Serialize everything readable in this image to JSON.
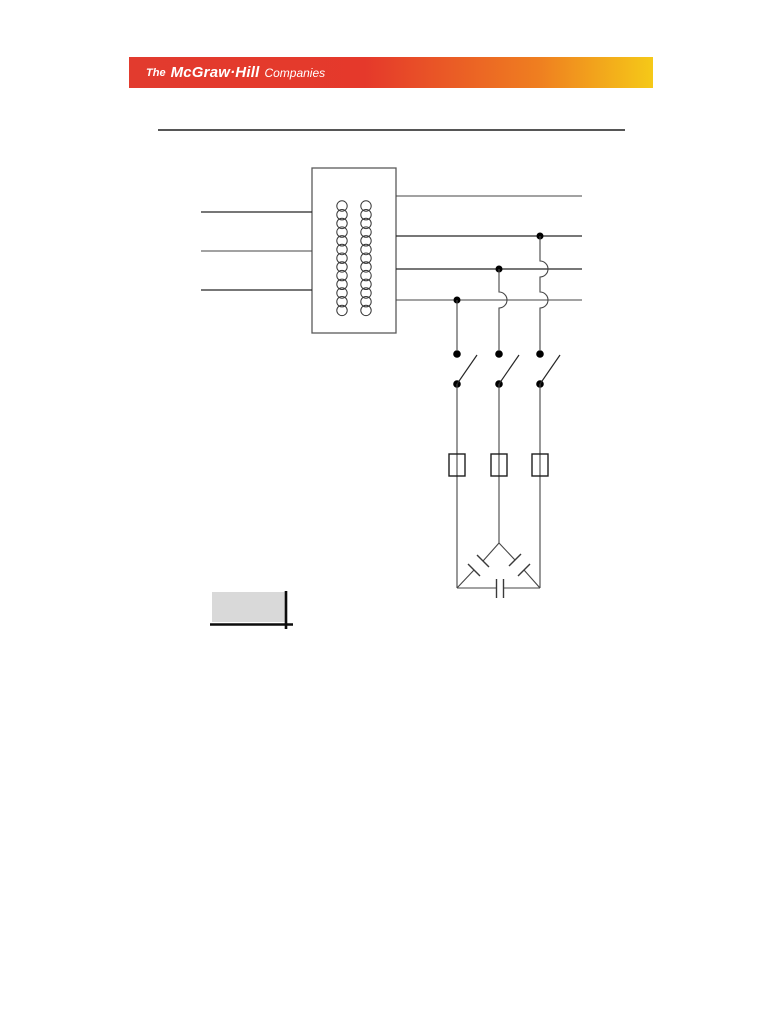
{
  "banner": {
    "text_prefix": "The",
    "text_brand": "McGraw·Hill",
    "text_suffix": "Companies",
    "gradient_colors": [
      "#e23b2e",
      "#e5392b",
      "#ef7e20",
      "#f5c918"
    ],
    "text_color": "#ffffff"
  },
  "figure": {
    "kind": "power-circuit-diagram",
    "line_color": "#454545",
    "components": {
      "transformer": "three-phase-transformer-with-two-windings",
      "supply_lines": 3,
      "feeder_lines": 4,
      "junction_dots": 3,
      "disconnect_switches": 3,
      "fuses": 3,
      "capacitor_bank": "delta-connected-3-capacitors"
    },
    "accent_box_color": "#d9d9d9"
  }
}
